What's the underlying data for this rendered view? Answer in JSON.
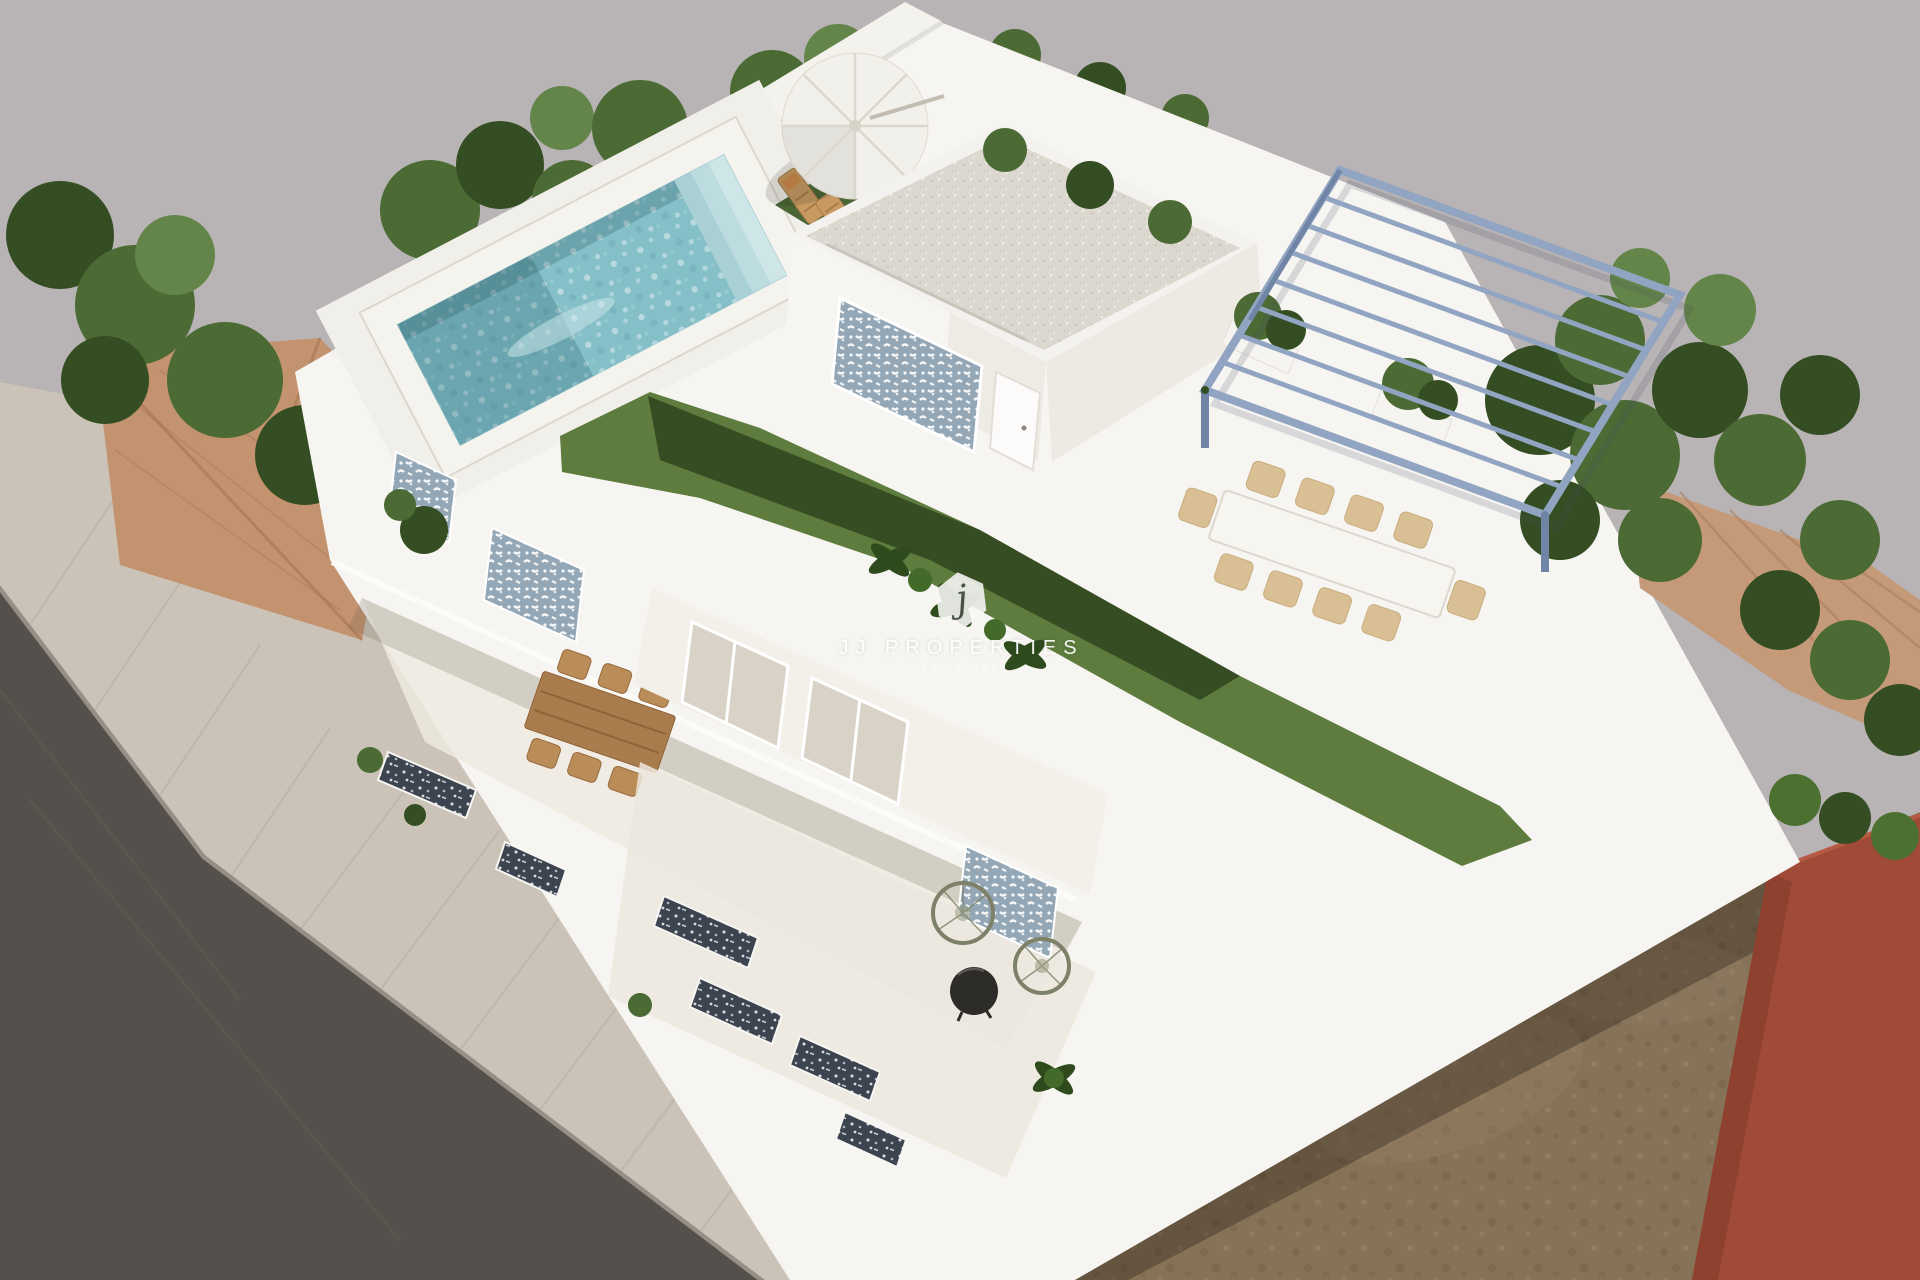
{
  "scene": {
    "type": "3d-architectural-render",
    "view": "high-angle aerial view",
    "description": "Photorealistic 3D render of a modern white flat-roof villa seen from above: rooftop terrace with mosaic swimming pool, artificial lawn strips, white penthouse volume with blue patterned accent wall, blue steel pergola over an outdoor dining terrace, sun loungers under a white parasol, stepped street-side terraces with wooden and rattan furniture, surrounded by trees, neighbouring terracotta roofs, a grey street and an empty dirt lot next to a red-brown building."
  },
  "watermark": {
    "logo_letter": "j",
    "brand": "JJ PROPERTIES",
    "tagline": "REAL ESTATE"
  },
  "scene_objects": [
    "street-road",
    "sidewalk",
    "boundary-wall",
    "neighbor-roof-left",
    "trees",
    "rooftop-pool",
    "sun-loungers",
    "parasol",
    "penthouse",
    "mosaic-accent-walls",
    "roof-lawn",
    "tropical-plants",
    "steel-pergola",
    "outdoor-dining-table",
    "wooden-dining-table",
    "rattan-chairs",
    "round-coffee-table",
    "balcony-mosaic-inserts",
    "dirt-lot",
    "red-building",
    "neighbor-roof-right"
  ],
  "colors": {
    "bg": "#b8b3b4",
    "road": "#55504b",
    "sidewalk": "#cbc3b7",
    "curb": "#b8b1a6",
    "building": "#f7f5f1",
    "wall_white": "#f4f2ed",
    "floor_cream": "#efeae1",
    "pool_water": "#85bfc8",
    "pool_coping": "#f5f3ee",
    "gravel": "#ddd8cf",
    "lawn": "#5d7c3d",
    "lawn_shadow": "#2c4122",
    "grass_patch": "#68874a",
    "tree": "#4b6a34",
    "tree_dark": "#344d22",
    "tree_light": "#648549",
    "hedge": "#4c7030",
    "terracotta": "#c3936f",
    "terracotta_right": "#c49a79",
    "dirt": "#867257",
    "dirt_dark": "#6f5d46",
    "red_building": "#a04b37",
    "red_building_dark": "#8c3f2e",
    "pergola": "#91a5c2",
    "pergola_dark": "#7085a6",
    "mosaic_base": "#93a7b6",
    "mosaic_dark_base": "#3c4450",
    "wood": "#a97c4e",
    "wood_light": "#c89a62",
    "wicker": "#d9bf94",
    "parasol": "#f2f0ea",
    "table_black": "#2e2c29",
    "rattan": "#7d8168",
    "watermark_text": "#ffffff",
    "watermark_letter": "#4a5148"
  }
}
